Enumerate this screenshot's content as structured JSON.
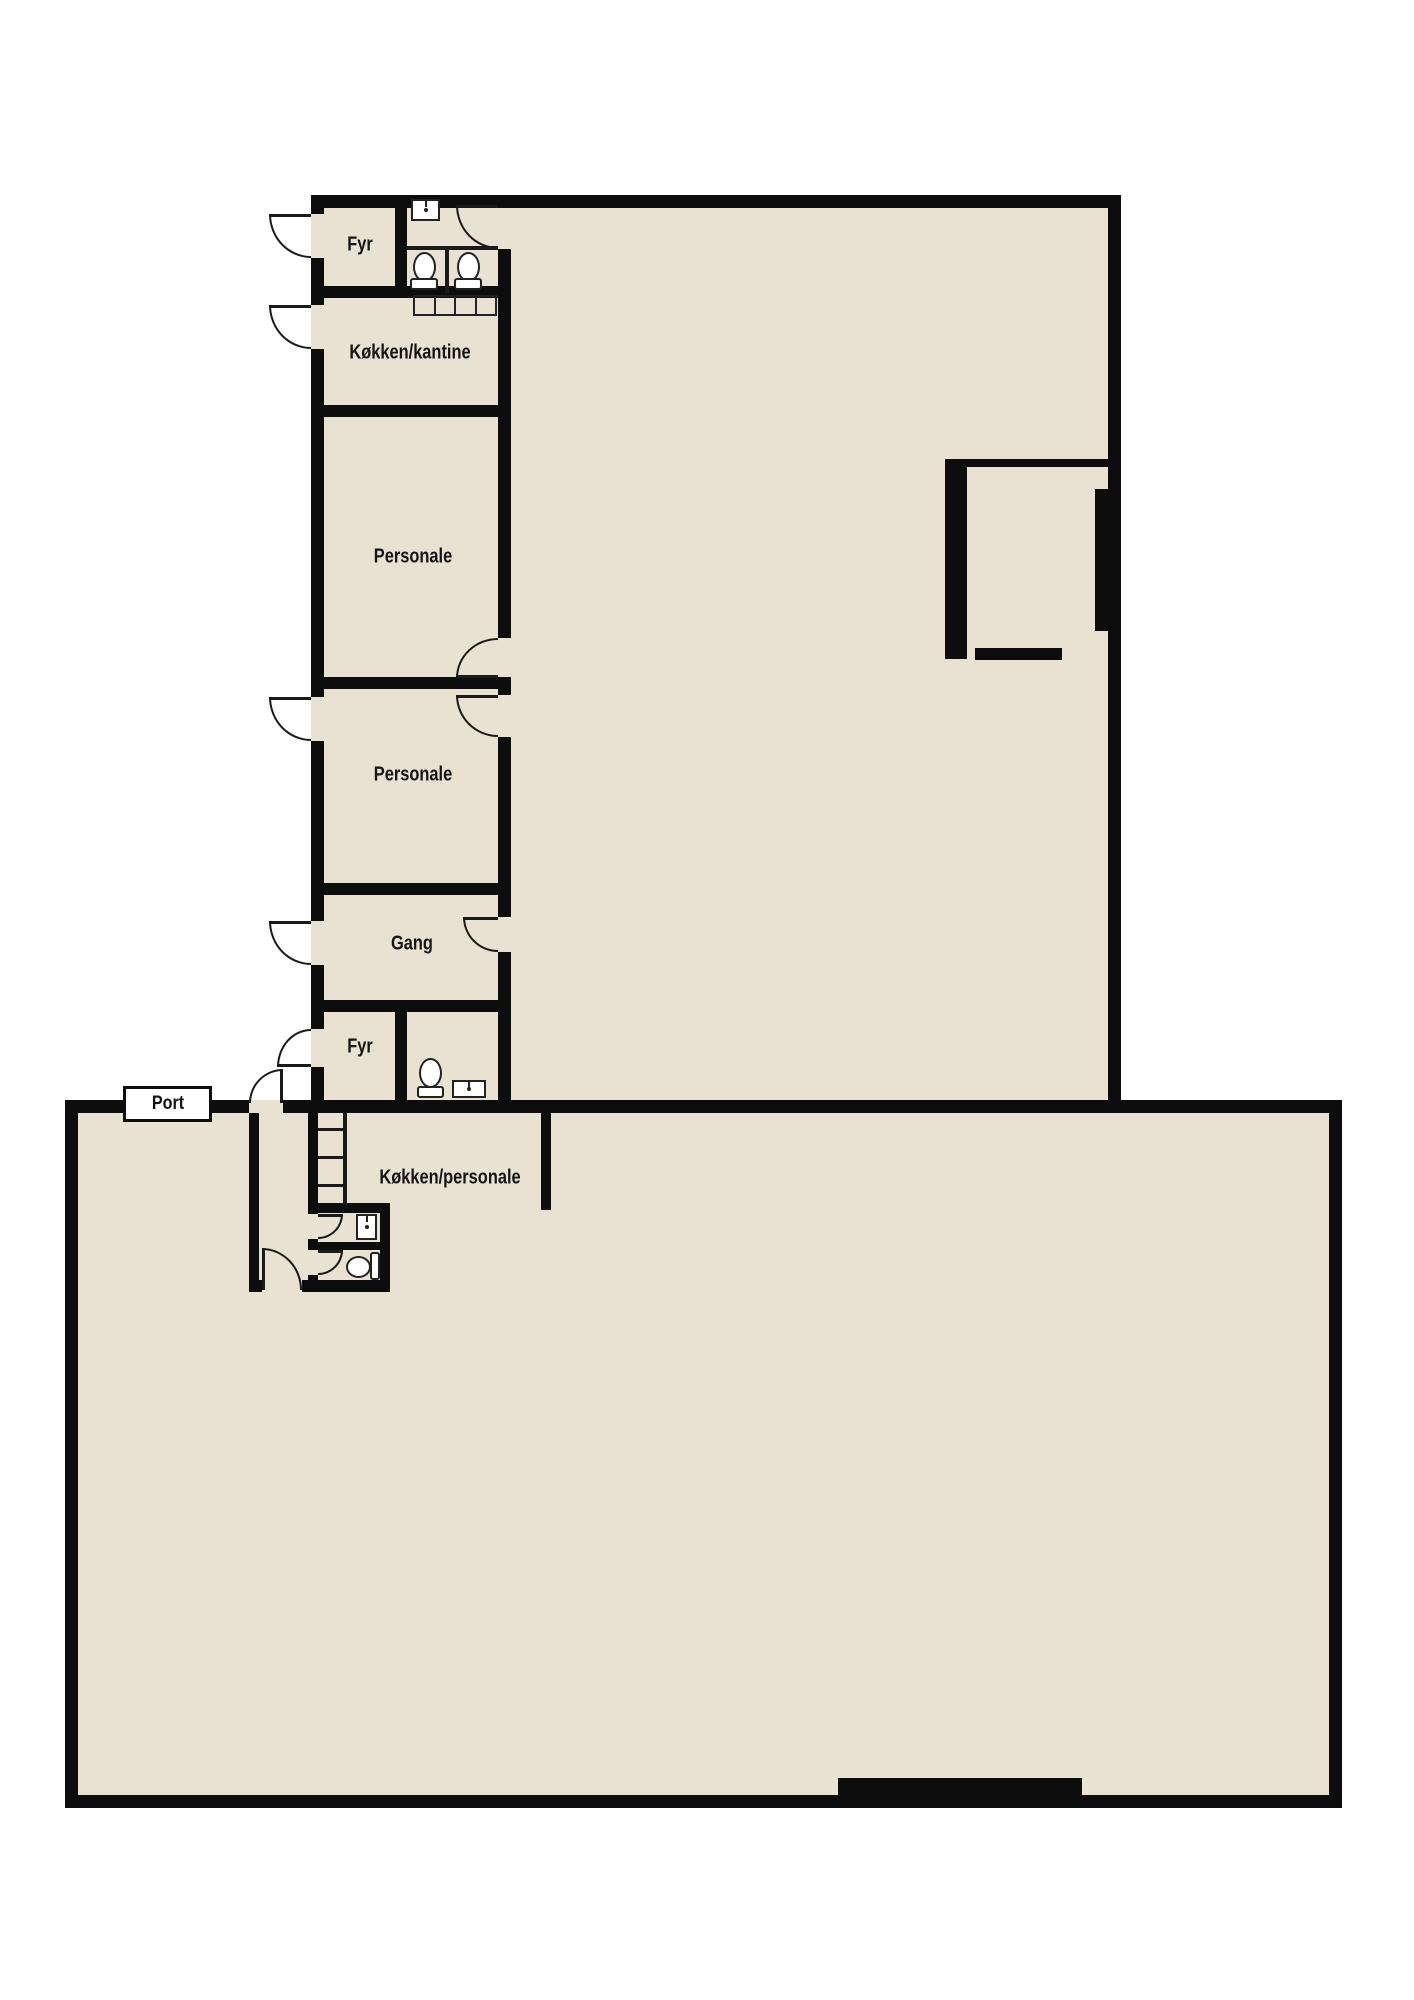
{
  "colors": {
    "background": "#ffffff",
    "floor": "#e9e1d1",
    "wall": "#0d0d0d",
    "fixture_outline": "#222222",
    "label_text": "#141414"
  },
  "rooms": [
    {
      "id": "fyr-top",
      "label": "Fyr"
    },
    {
      "id": "kokken-kantine",
      "label": "Køkken/kantine"
    },
    {
      "id": "personale-1",
      "label": "Personale"
    },
    {
      "id": "personale-2",
      "label": "Personale"
    },
    {
      "id": "gang",
      "label": "Gang"
    },
    {
      "id": "fyr-bottom",
      "label": "Fyr"
    },
    {
      "id": "kokken-personale",
      "label": "Køkken/personale"
    },
    {
      "id": "port",
      "label": "Port"
    }
  ],
  "fixtures": [
    {
      "type": "sink-icon",
      "location": "wc-top"
    },
    {
      "type": "toilet-icon",
      "location": "wc-top-stall-1"
    },
    {
      "type": "toilet-icon",
      "location": "wc-top-stall-2"
    },
    {
      "type": "kitchen-counter-icon",
      "location": "kokken-kantine"
    },
    {
      "type": "toilet-icon",
      "location": "wc-fyr-bottom"
    },
    {
      "type": "sink-icon",
      "location": "wc-fyr-bottom"
    },
    {
      "type": "stairs-icon",
      "location": "lower-hall"
    },
    {
      "type": "sink-icon",
      "location": "wc-lower"
    },
    {
      "type": "toilet-icon",
      "location": "wc-lower"
    },
    {
      "type": "door-arc",
      "count": 13
    },
    {
      "type": "gate-icon",
      "location": "lower-hall-bottom-wall"
    }
  ]
}
